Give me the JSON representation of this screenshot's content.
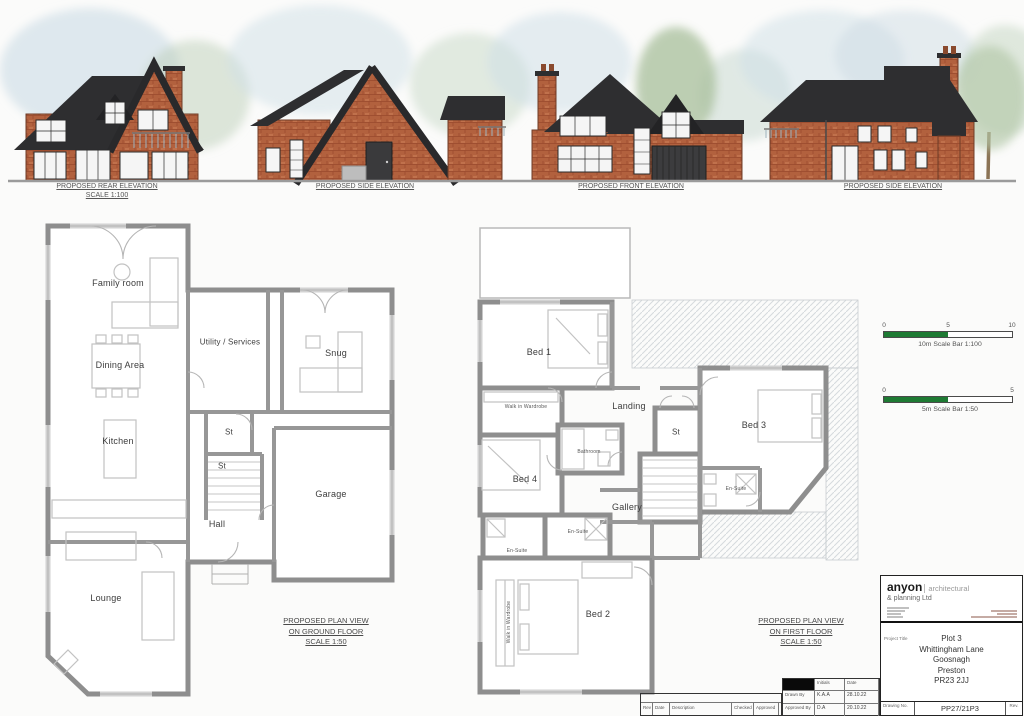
{
  "elevation_labels": [
    {
      "title": "PROPOSED REAR ELEVATION",
      "scale": "SCALE 1:100"
    },
    {
      "title": "PROPOSED SIDE ELEVATION",
      "scale": ""
    },
    {
      "title": "PROPOSED FRONT ELEVATION",
      "scale": ""
    },
    {
      "title": "PROPOSED SIDE ELEVATION",
      "scale": ""
    }
  ],
  "ground_floor": {
    "rooms": [
      "Family room",
      "Dining Area",
      "Utility / Services",
      "Snug",
      "Kitchen",
      "St",
      "St",
      "Hall",
      "Garage",
      "Lounge"
    ],
    "caption": {
      "line1": "PROPOSED PLAN VIEW",
      "line2": "ON GROUND FLOOR",
      "line3": "SCALE 1:50"
    }
  },
  "first_floor": {
    "rooms": [
      "Bed 1",
      "Walk in Wardrobe",
      "Landing",
      "St",
      "Bed 3",
      "Bathroom",
      "Bed 4",
      "En-Suite",
      "Gallery",
      "En-Suite",
      "En-Suite",
      "Bed 2",
      "Walk in Wardrobe"
    ],
    "caption": {
      "line1": "PROPOSED PLAN VIEW",
      "line2": "ON FIRST FLOOR",
      "line3": "SCALE 1:50"
    }
  },
  "scale_bars": {
    "bar100": {
      "t0": "0",
      "t1": "5",
      "t2": "10",
      "label": "10m Scale Bar 1:100"
    },
    "bar50": {
      "t0": "0",
      "t1": "5",
      "label": "5m Scale Bar 1:50"
    }
  },
  "title_block": {
    "company_name": "anyon",
    "company_type": "architectural",
    "company_sub": "& planning Ltd",
    "project_label": "Project Title",
    "project": {
      "line1": "Plot 3",
      "line2": "Whittingham Lane",
      "line3": "Goosnagh",
      "line4": "Preston",
      "line5": "PR23 2JJ"
    },
    "drawing_no_label": "Drawing No.",
    "drawing_no": "PP27/21P3",
    "rev_label": "Rev.",
    "rev": "A",
    "status_label": "Drawing Status",
    "status": "PLANNING APPROVAL"
  },
  "sign_table": {
    "initials_header": "Initials",
    "date_header": "Date",
    "drawn_label": "Drawn By",
    "drawn_initials": "K.A.A",
    "drawn_date": "28.10.22",
    "approved_label": "Approved By",
    "approved_initials": "D.A",
    "approved_date": "20.10.22"
  },
  "revision_table": {
    "col_rev": "Rev",
    "col_date": "Date",
    "col_description": "Description",
    "col_checked": "Checked",
    "col_approved": "Approved"
  },
  "colors": {
    "brick": "#b2613e",
    "roof": "#2e2e30",
    "scalebar_green": "#1e7a33",
    "wall_gray": "#8e8e8e"
  }
}
